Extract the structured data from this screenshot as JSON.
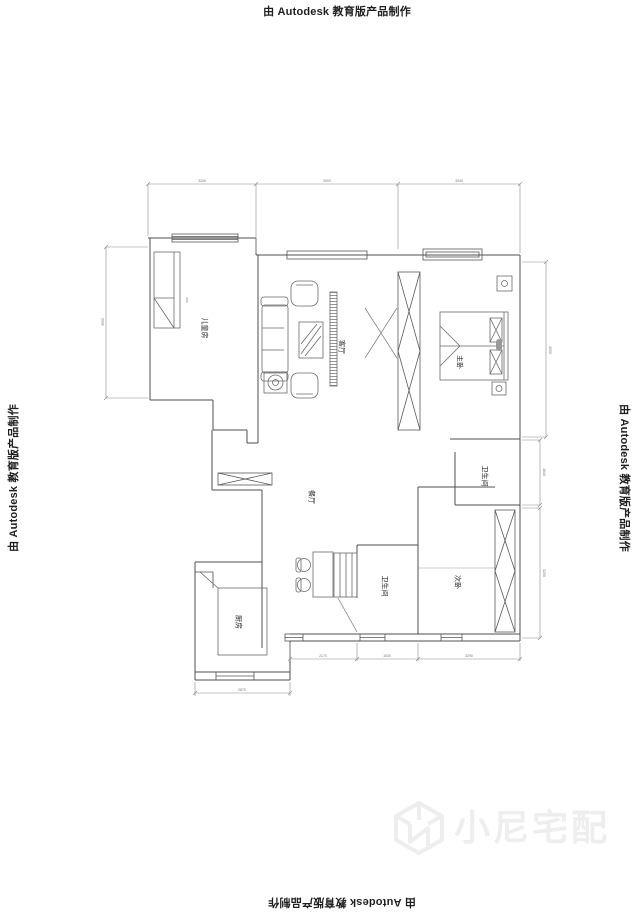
{
  "watermark": {
    "autodesk_label": "由 Autodesk 教育版产品制作"
  },
  "brand": {
    "name": "小尼宅配",
    "logo": "cube-n-icon"
  },
  "floorplan": {
    "rooms": [
      {
        "key": "children-room",
        "label": "儿童房"
      },
      {
        "key": "living-room",
        "label": "客厅"
      },
      {
        "key": "master-bedroom",
        "label": "主卧"
      },
      {
        "key": "dining-room",
        "label": "餐厅"
      },
      {
        "key": "bathroom-1",
        "label": "卫生间"
      },
      {
        "key": "bathroom-2",
        "label": "卫生间"
      },
      {
        "key": "second-bedroom",
        "label": "次卧"
      },
      {
        "key": "kitchen",
        "label": "厨房"
      }
    ],
    "dimensions": {
      "top": [
        "3200",
        "3900",
        "3340"
      ],
      "left": [
        "3900"
      ],
      "right": [
        "4550",
        "1640",
        "3250"
      ],
      "bottom": [
        "2170",
        "1530",
        "3290"
      ],
      "kitchen_bottom": [
        "2870"
      ],
      "children_inner": [
        "900"
      ]
    },
    "colors": {
      "wall": "#4f4f4f",
      "furniture": "#6a6a6a",
      "dimension": "#8a8a8a",
      "label": "#2b2b2b",
      "watermark_text": "#1f1f1f",
      "brand_watermark": "#eeeeee"
    }
  }
}
